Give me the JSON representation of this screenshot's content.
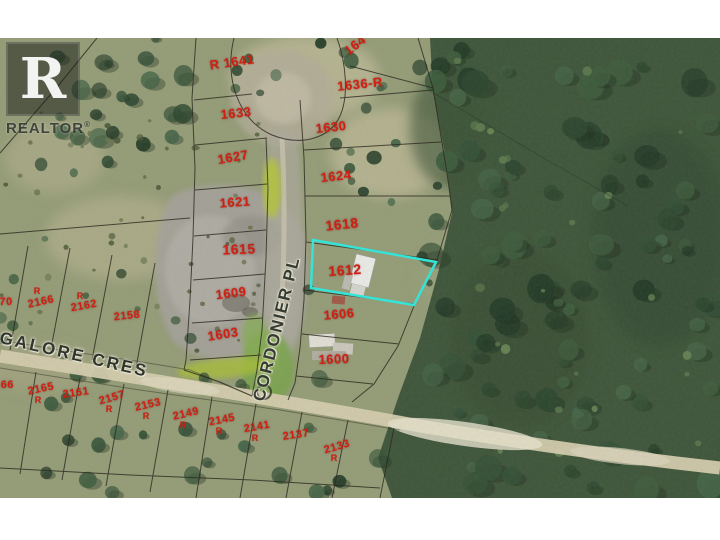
{
  "canvas": {
    "width": 720,
    "height": 540,
    "margin_color": "#ffffff",
    "map_top": 38,
    "map_height": 460
  },
  "logo": {
    "letter": "R",
    "wordmark": "REALTOR",
    "registered": "®"
  },
  "map": {
    "label_color": "#cf2013",
    "highlight": {
      "lot": "1612",
      "color": "#36e3d7",
      "points": "313,202 436,224 414,267 311,250"
    },
    "streets": [
      {
        "name": "CORDONIER PL",
        "x": 277,
        "y": 291,
        "rotation": -76,
        "size": 17,
        "spacing": 1.5,
        "color": "#363c32"
      },
      {
        "name": "GALORE CRES",
        "x": 74,
        "y": 317,
        "rotation": 13,
        "size": 17,
        "spacing": 2.5,
        "color": "#30352c"
      }
    ],
    "lots": [
      {
        "label": "R 1641",
        "x": 232,
        "y": 24,
        "rot": -8,
        "size": 13
      },
      {
        "label": "164",
        "x": 355,
        "y": 7,
        "rot": -38,
        "size": 13
      },
      {
        "label": "1636-R",
        "x": 360,
        "y": 46,
        "rot": -6,
        "size": 13
      },
      {
        "label": "1633",
        "x": 236,
        "y": 75,
        "rot": -6,
        "size": 13
      },
      {
        "label": "1630",
        "x": 331,
        "y": 89,
        "rot": -6,
        "size": 13
      },
      {
        "label": "1627",
        "x": 233,
        "y": 119,
        "rot": -10,
        "size": 13
      },
      {
        "label": "1624",
        "x": 336,
        "y": 138,
        "rot": -6,
        "size": 13
      },
      {
        "label": "1621",
        "x": 235,
        "y": 164,
        "rot": -4,
        "size": 13
      },
      {
        "label": "1618",
        "x": 342,
        "y": 186,
        "rot": -6,
        "size": 14
      },
      {
        "label": "1615",
        "x": 239,
        "y": 211,
        "rot": -2,
        "size": 14
      },
      {
        "label": "1612",
        "x": 345,
        "y": 232,
        "rot": -4,
        "size": 14
      },
      {
        "label": "1609",
        "x": 231,
        "y": 255,
        "rot": -7,
        "size": 13
      },
      {
        "label": "1606",
        "x": 339,
        "y": 276,
        "rot": -5,
        "size": 13
      },
      {
        "label": "1603",
        "x": 223,
        "y": 296,
        "rot": -9,
        "size": 13
      },
      {
        "label": "1600",
        "x": 334,
        "y": 321,
        "rot": -2,
        "size": 13,
        "bold": true
      },
      {
        "label": "70",
        "x": 6,
        "y": 264,
        "rot": 0,
        "size": 11
      },
      {
        "label": "2166",
        "x": 41,
        "y": 264,
        "rot": -12,
        "size": 11
      },
      {
        "label": "2162",
        "x": 84,
        "y": 268,
        "rot": -10,
        "size": 11
      },
      {
        "label": "2158",
        "x": 127,
        "y": 278,
        "rot": -6,
        "size": 11
      },
      {
        "label": "166",
        "x": 4,
        "y": 347,
        "rot": 0,
        "size": 11
      },
      {
        "label": "2165",
        "x": 41,
        "y": 351,
        "rot": -12,
        "size": 11
      },
      {
        "label": "2161",
        "x": 76,
        "y": 355,
        "rot": -8,
        "size": 11
      },
      {
        "label": "2157",
        "x": 112,
        "y": 360,
        "rot": -16,
        "size": 11
      },
      {
        "label": "2153",
        "x": 148,
        "y": 367,
        "rot": -13,
        "size": 11
      },
      {
        "label": "2149",
        "x": 186,
        "y": 376,
        "rot": -13,
        "size": 11
      },
      {
        "label": "2145",
        "x": 222,
        "y": 382,
        "rot": -11,
        "size": 11
      },
      {
        "label": "2141",
        "x": 257,
        "y": 389,
        "rot": -10,
        "size": 11
      },
      {
        "label": "2137",
        "x": 296,
        "y": 397,
        "rot": -8,
        "size": 11
      },
      {
        "label": "2133",
        "x": 337,
        "y": 409,
        "rot": -16,
        "size": 11
      }
    ],
    "sub_marks": [
      {
        "label": "R",
        "x": 37,
        "y": 253
      },
      {
        "label": "R",
        "x": 80,
        "y": 258
      },
      {
        "label": "R",
        "x": 38,
        "y": 362
      },
      {
        "label": "R",
        "x": 109,
        "y": 371
      },
      {
        "label": "R",
        "x": 146,
        "y": 378
      },
      {
        "label": "R",
        "x": 183,
        "y": 387
      },
      {
        "label": "R",
        "x": 219,
        "y": 393
      },
      {
        "label": "R",
        "x": 255,
        "y": 400
      },
      {
        "label": "R",
        "x": 334,
        "y": 420
      }
    ]
  }
}
